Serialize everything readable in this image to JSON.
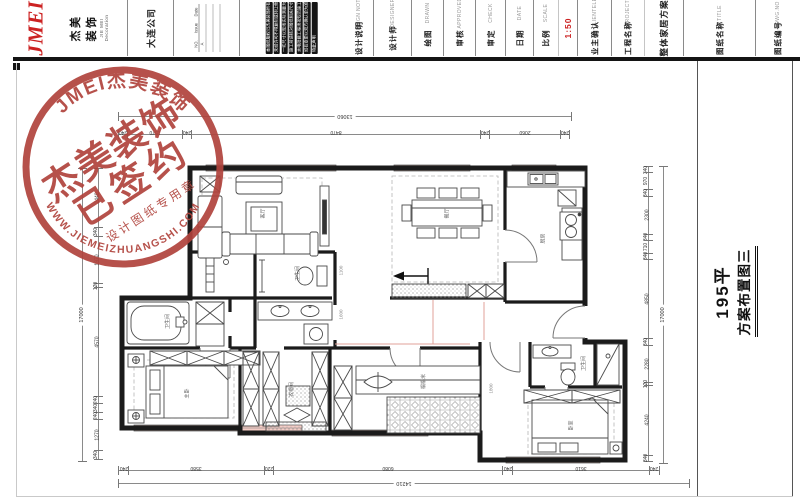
{
  "sheet": {
    "accent_red": "#cc2222",
    "stamp_red": "#b0433c",
    "window_pink": "#f5cdc6",
    "wall_black": "#1b1b1b"
  },
  "title_block": {
    "logo": {
      "mark": "JMEI",
      "name_cn": "杰美装饰",
      "name_en": "JIE MEI Decoration"
    },
    "company": "大连公司",
    "revision": {
      "headers": [
        "NO.",
        "Issue",
        "Date"
      ],
      "rows": [
        "A",
        "",
        ""
      ]
    },
    "notes": {
      "label_cn": "设计说明",
      "label_en": "DESIGN NOTES",
      "lines": [
        "本图纸版权归杰美装饰所有",
        "未经许可不得复制或转让他人",
        "一切尺寸以现场实际测量为准",
        "施工前请核对图纸相关尺寸",
        "水电隐蔽工程须按规范施工",
        "如有变更以双方确认单为准",
        "特此声明"
      ]
    },
    "fields": [
      {
        "cn": "设计师",
        "en": "DESIGNER",
        "value": ""
      },
      {
        "cn": "绘图",
        "en": "DRAWN",
        "value": ""
      },
      {
        "cn": "审核",
        "en": "APPROVED",
        "value": ""
      },
      {
        "cn": "审定",
        "en": "CHECK",
        "value": ""
      },
      {
        "cn": "日期",
        "en": "DATE",
        "value": ""
      },
      {
        "cn": "比例",
        "en": "SCALE",
        "value": "1:50"
      },
      {
        "cn": "业主确认",
        "en": "CLIENTELE",
        "value": ""
      },
      {
        "cn": "工程名称",
        "en": "PROJECT",
        "value": "整体家居方案"
      },
      {
        "cn": "图纸名称",
        "en": "TITLE",
        "value": ""
      },
      {
        "cn": "图纸编号",
        "en": "DWG.NO",
        "value": ""
      }
    ]
  },
  "stamp": {
    "arc_top": "JMEI杰美装饰",
    "line1": "杰美装饰",
    "line2": "已签约",
    "line3": "设计图纸专用章",
    "arc_bottom": "WWW.JIEMEIZHUANGSHI.COM"
  },
  "side_title": {
    "line1": "195平",
    "line2": "方案布置图三"
  },
  "dimensions": {
    "top": {
      "total": "13060",
      "segments": [
        "240",
        "1570",
        "240",
        "8470",
        "240",
        "2060",
        "240"
      ]
    },
    "bottom": {
      "total": "14210",
      "segments": [
        "240",
        "3580",
        "220",
        "6080",
        "240",
        "3610",
        "240"
      ]
    },
    "right": {
      "total": "17000",
      "segments": [
        "340",
        "970",
        "340",
        "2300",
        "340",
        "710",
        "340",
        "4850",
        "340",
        "2280",
        "120",
        "4240",
        "340"
      ]
    },
    "left": {
      "total": "17000",
      "segments": [
        "2440",
        "340",
        "1970",
        "120",
        "4570",
        "240",
        "340",
        "240",
        "1270",
        "340"
      ]
    }
  },
  "plan": {
    "rooms": [
      "客厅",
      "餐厅",
      "厨房",
      "卫生间",
      "卫生间",
      "主卧",
      "衣帽间",
      "榻榻米",
      "卧室",
      "卫生间"
    ],
    "inner_dims": [
      "1100",
      "1600",
      "1800"
    ]
  }
}
